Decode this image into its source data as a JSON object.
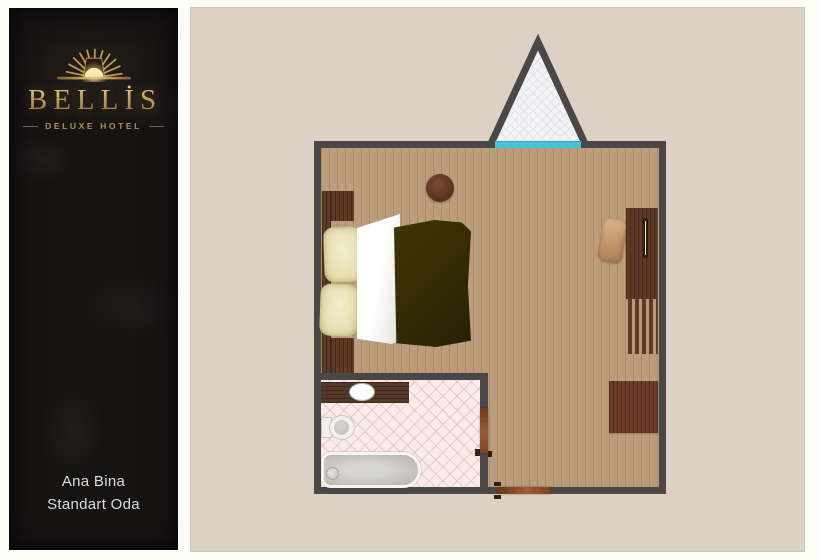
{
  "brand": {
    "name": "BELLİS",
    "tagline": "DELUXE HOTEL",
    "emblem": "sunburst-icon"
  },
  "room_label": {
    "building": "Ana Bina",
    "room_type": "Standart Oda"
  },
  "colors": {
    "brand_gold": "#c9a25e",
    "leather_black": "#161313",
    "panel_beige": "#dcd1c3",
    "wall_gray": "#4c4747",
    "window_cyan": "#45c4d6",
    "floor_wood": "#bb9c7b",
    "furniture_wood": "#5d3b27",
    "blanket_olive": "#332a05",
    "bath_tile_pink": "#f8ebea"
  },
  "floorplan": {
    "type": "hotel-room-floor-plan",
    "items": [
      "triangular-bay-window",
      "window-sill",
      "wood-floor",
      "bed",
      "headboard",
      "nightstand-top",
      "nightstand-bottom",
      "pillow",
      "pillow",
      "duvet",
      "blanket",
      "round-side-table",
      "chair",
      "wardrobe-desk",
      "wardrobe-handle",
      "slatted-bench",
      "square-table",
      "bathroom",
      "vanity-counter",
      "sink",
      "toilet",
      "bathtub",
      "tub-drain",
      "bathroom-door",
      "entry-door"
    ]
  }
}
